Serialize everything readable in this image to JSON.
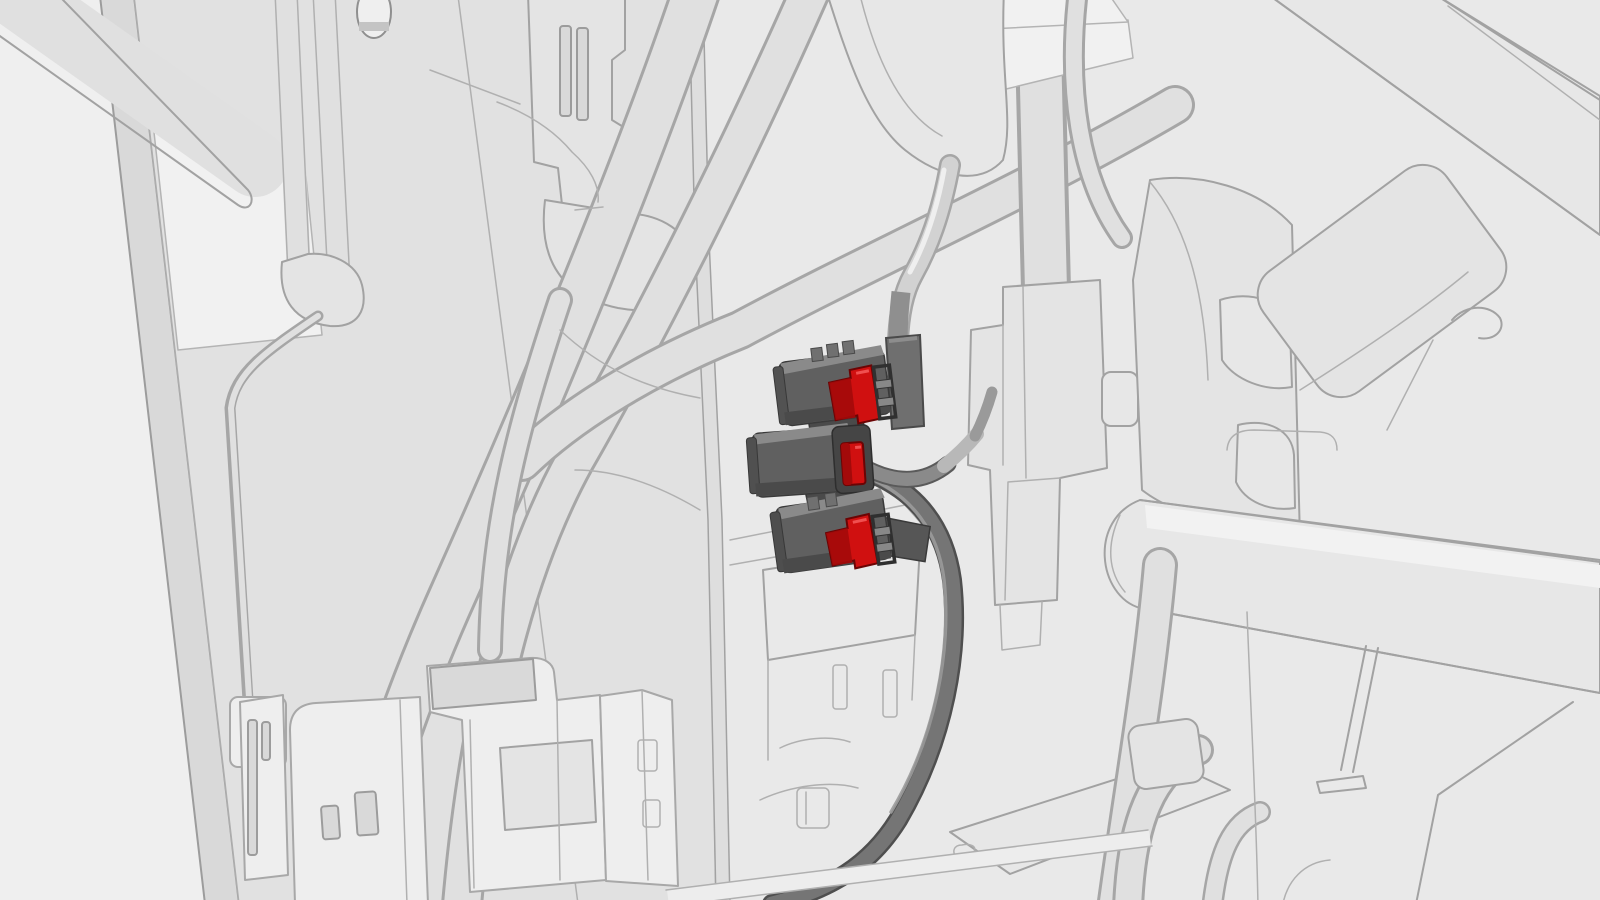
{
  "illustration": {
    "kind": "vehicle-service-3d-callout",
    "text_content": "none",
    "highlighted_part_count": 3
  },
  "colors": {
    "background": "#e9e9e9",
    "ghost_line": "#a2a2a2",
    "ghost_fill": "#e4e4e4",
    "connector_body": "#606060",
    "connector_body_top": "#8a8a8a",
    "connector_shadow": "#4a4a4a",
    "lock_tab_red": "#d01010",
    "lock_tab_red_dark": "#a30a0a",
    "lock_tab_highlight": "#f05050",
    "cable_dark": "#757575",
    "cable_dark_outline": "#4f4f4f",
    "cable_light": "#d2d2d2",
    "cable_light_outline": "#9c9c9c",
    "cable_sleeve": "#b8b8b8",
    "boot_gray": "#6f6f6f",
    "mount_strip": "#4a4a4a"
  },
  "connectors": [
    {
      "position": "top",
      "type": "electrical-connector",
      "lock_tab": "red",
      "state": "highlighted"
    },
    {
      "position": "middle",
      "type": "electrical-connector",
      "lock_tab": "red",
      "state": "highlighted"
    },
    {
      "position": "bottom",
      "type": "electrical-connector",
      "lock_tab": "red",
      "state": "highlighted"
    }
  ]
}
